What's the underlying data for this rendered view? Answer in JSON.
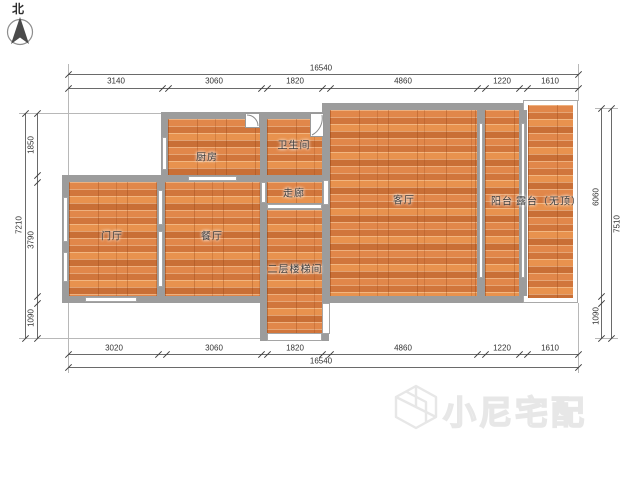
{
  "compass": {
    "label": "北"
  },
  "rooms": [
    {
      "name": "kitchen",
      "label": "厨房"
    },
    {
      "name": "bathroom",
      "label": "卫生间"
    },
    {
      "name": "corridor",
      "label": "走廊"
    },
    {
      "name": "foyer",
      "label": "门厅"
    },
    {
      "name": "dining",
      "label": "餐厅"
    },
    {
      "name": "stairwell",
      "label": "二层楼梯间"
    },
    {
      "name": "living",
      "label": "客厅"
    },
    {
      "name": "balcony",
      "label": "阳台"
    },
    {
      "name": "terrace",
      "label": "露台（无顶）"
    }
  ],
  "dims": {
    "top": {
      "total": "16540",
      "segments": [
        "3140",
        "3060",
        "1820",
        "4860",
        "1220",
        "1610"
      ]
    },
    "bottom": {
      "total": "16540",
      "segments": [
        "3020",
        "3060",
        "1820",
        "4860",
        "1220",
        "1610"
      ]
    },
    "left": {
      "total": "7210",
      "segments": [
        "1850",
        "3790",
        "1090"
      ]
    },
    "right": {
      "total": "7510",
      "segments": [
        "6060",
        "1090"
      ]
    }
  },
  "watermark": {
    "text": "小尼宅配"
  },
  "colors": {
    "floor": "#db7f3e",
    "wall": "#9c9c9c",
    "watermark": "#e7e7e7"
  }
}
